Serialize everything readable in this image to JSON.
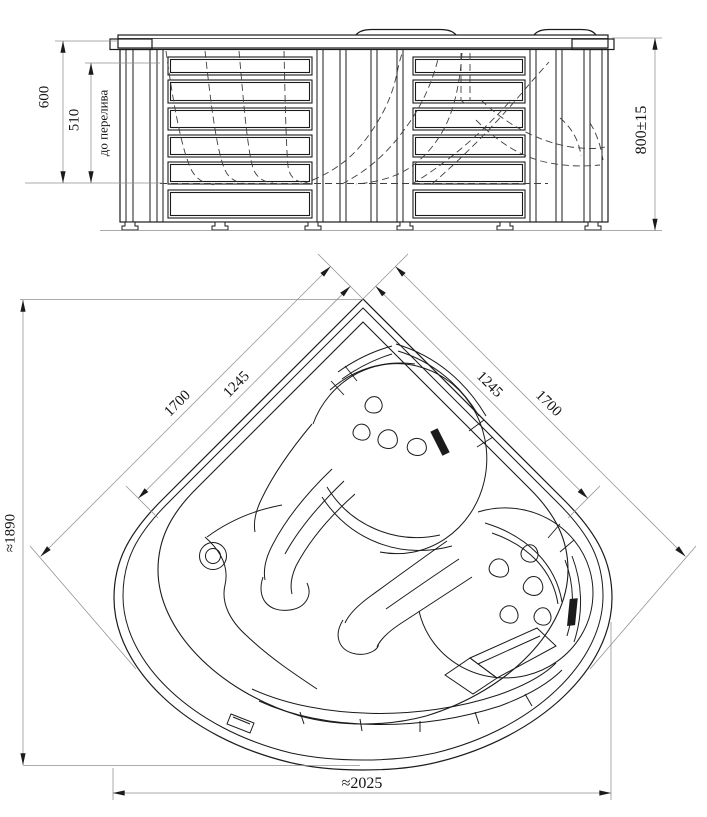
{
  "drawing": {
    "title": "corner hydromassage bathtub — two-view dimensional drawing",
    "views": {
      "front": {
        "name": "front elevation",
        "dims": {
          "depth_total": {
            "label": "600"
          },
          "depth_overflow": {
            "label": "510"
          },
          "overflow_note": {
            "label": "до перелива"
          },
          "height_overall": {
            "label": "800±15"
          }
        }
      },
      "plan": {
        "name": "top plan view",
        "dims": {
          "side_left_outer": {
            "label": "1700"
          },
          "side_left_inner": {
            "label": "1245"
          },
          "side_right_inner": {
            "label": "1245"
          },
          "side_right_outer": {
            "label": "1700"
          },
          "height_overall": {
            "label": "≈1890"
          },
          "width_overall": {
            "label": "≈2025"
          }
        }
      }
    },
    "colors": {
      "line": "#1b1b1b",
      "thin_line": "#8f8f8f",
      "hidden_line": "#3f3f3f",
      "background": "#ffffff"
    }
  }
}
